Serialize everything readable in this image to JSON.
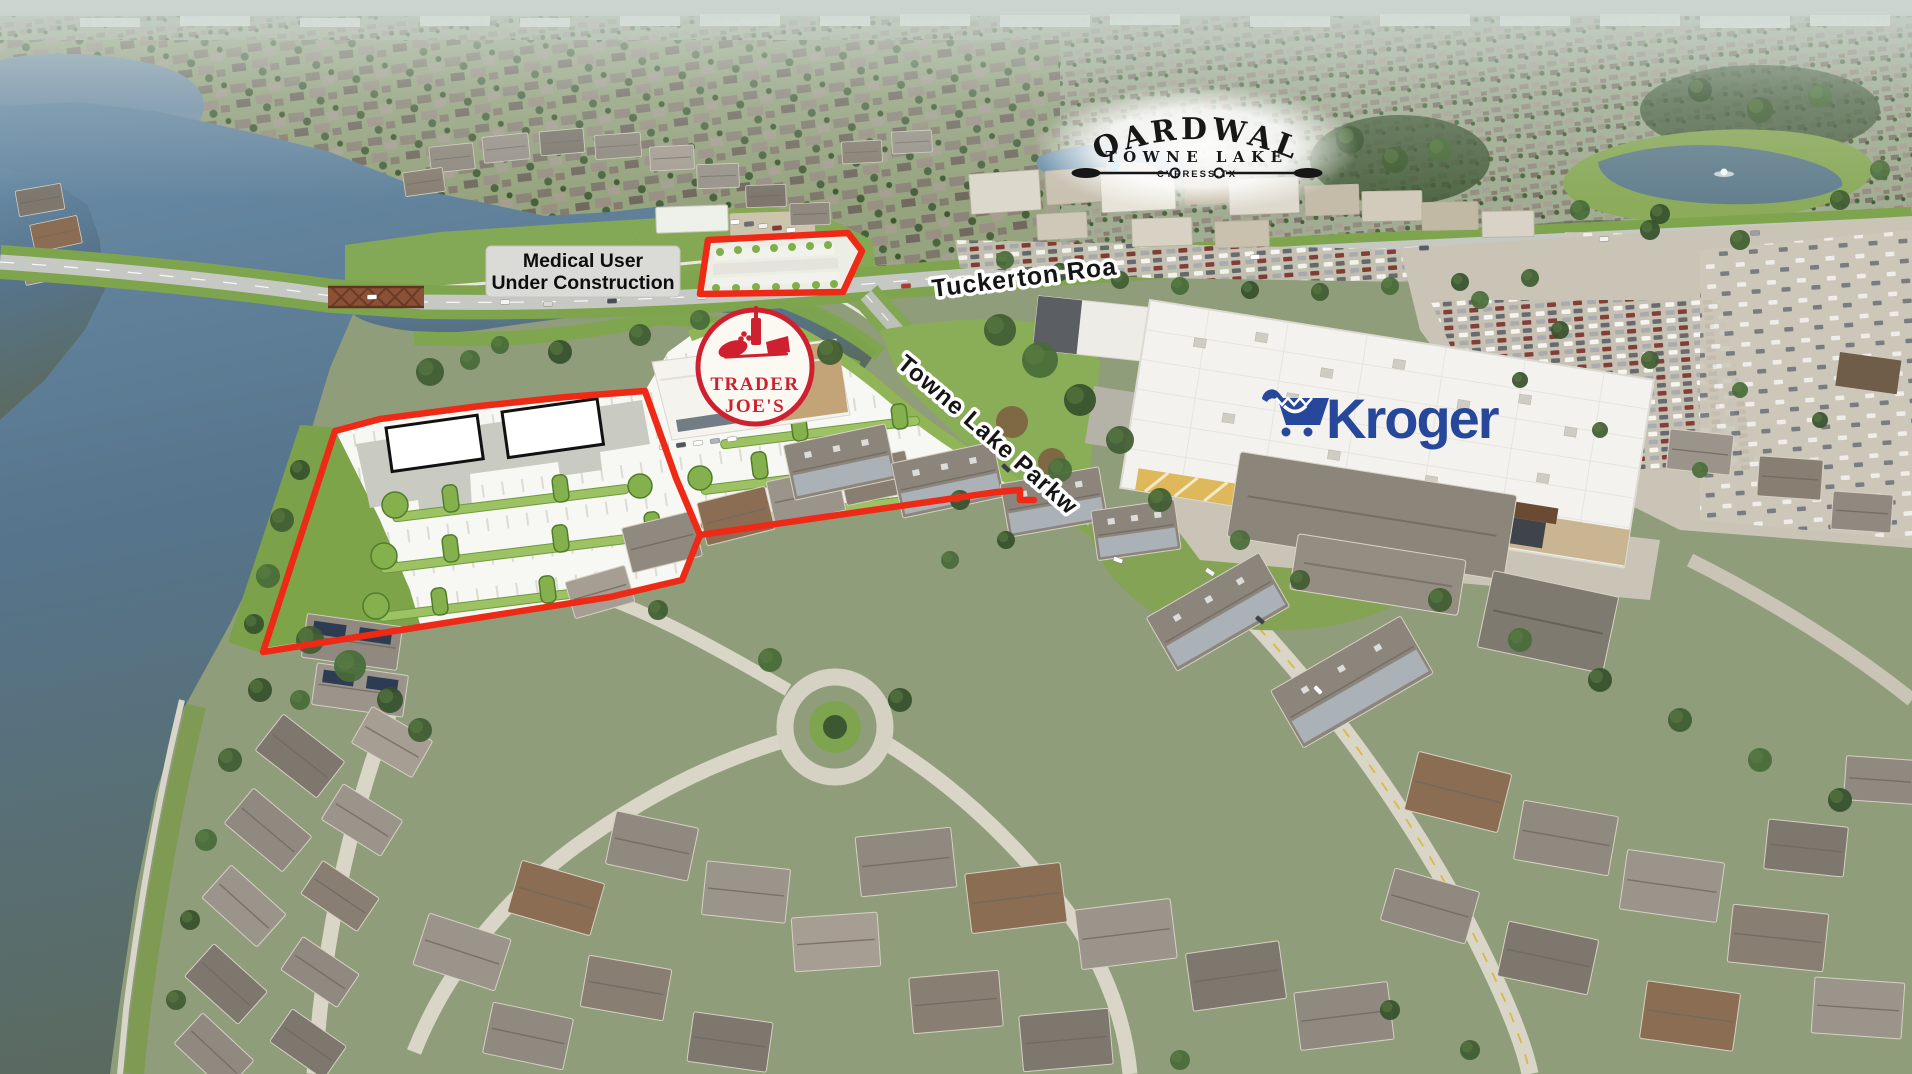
{
  "labels": {
    "boardwalk": {
      "title": "BOARDWALK",
      "subtitle": "TOWNE LAKE",
      "location": "CYPRESS,TX"
    },
    "medical_user": {
      "line1": "Medical User",
      "line2": "Under Construction"
    },
    "tuckerton_road": "Tuckerton Road",
    "towne_lake_parkway": "Towne Lake Parkway",
    "trader_joes": {
      "line1": "TRADER",
      "line2": "JOE'S"
    },
    "kroger": "Kroger"
  },
  "colors": {
    "boundary_red": "#ee2a17",
    "kroger_blue": "#27479b",
    "trader_joes_red": "#cf2030",
    "label_background": "#dadbd6",
    "label_text": "#0e0e0e",
    "water": "#5d7e98"
  },
  "icons": {
    "boardwalk_oars": "crossed-oars-icon",
    "kroger_cart": "shopping-cart-icon",
    "trader_joes_emblem": "wine-and-bread-icon"
  }
}
